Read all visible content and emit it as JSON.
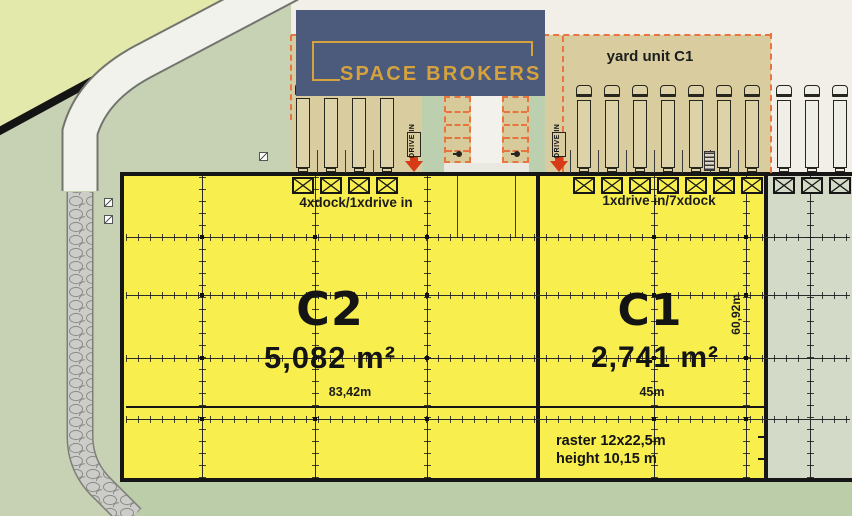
{
  "logo": {
    "text": "SPACE BROKERS"
  },
  "yard": {
    "label": "yard unit C1"
  },
  "drive_in": {
    "label": "DRIVE IN"
  },
  "unit_c2": {
    "name": "C2",
    "area": "5,082 m²",
    "width_label": "83,42m",
    "dock_info": "4xdock/1xdrive in"
  },
  "unit_c1": {
    "name": "C1",
    "area": "2,741 m²",
    "width_label": "45m",
    "depth_label": "60,92m",
    "dock_info": "1xdrive in/7xdock",
    "raster_note": "raster 12x22,5m",
    "height_note": "height 10,15 m"
  },
  "counts": {
    "c2_trucks": 4,
    "c2_docks": 4,
    "c2_drive_ins": 1,
    "c1_trucks": 7,
    "c1_docks": 7,
    "c1_drive_ins": 1,
    "adjacent_trucks": 3,
    "adjacent_docks": 3,
    "parking_stall_rows": 5,
    "parking_columns": 2
  },
  "colors": {
    "unit_fill": "#f8ee4e",
    "adjacent_fill": "#d3dac8",
    "yard_fill": "#d9cd9f",
    "yard_border": "#e8743f",
    "arrow_red": "#d63a16",
    "wall": "#161616",
    "logo_bg": "#4c5b7c",
    "logo_gold": "#d5a23d",
    "cream": "#f1efe8",
    "landscape_green": "#c7d2b5",
    "light_green": "#e2e9ab"
  }
}
